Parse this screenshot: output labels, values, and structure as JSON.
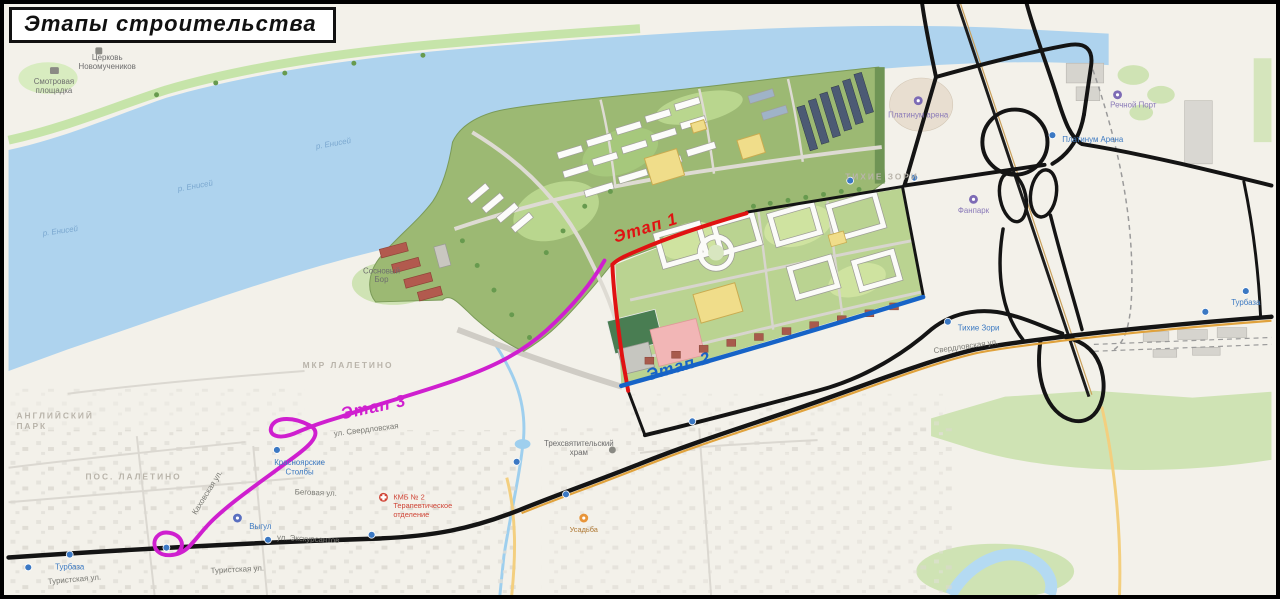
{
  "title": "Этапы строительства",
  "stages": [
    {
      "label": "Этап 1",
      "color": "#e01212"
    },
    {
      "label": "Этап 2",
      "color": "#1663c7"
    },
    {
      "label": "Этап 3",
      "color": "#cf1fcf"
    }
  ],
  "labels": {
    "river": "р. Енисей",
    "church_line1": "Церковь",
    "church_line2": "Новомучеников",
    "viewpoint_line1": "Смотровая",
    "viewpoint_line2": "площадка",
    "district_tikhie_zori": "ТИХИЕ ЗОРИ",
    "district_mkr_laletino": "МКР ЛАЛЕТИНО",
    "district_pos_laletino": "ПОС. ЛАЛЕТИНО",
    "district_english_park_line1": "АНГЛИЙСКИЙ",
    "district_english_park_line2": "ПАРК",
    "arena_poi": "Платинум арена",
    "arena_stop": "Платинум Арена",
    "rechnoy_port": "Речной Порт",
    "fanpark": "Фанпарк",
    "tikhie_zori_stop": "Тихие Зори",
    "stolby_line1": "Красноярские",
    "stolby_line2": "Столбы",
    "vygul": "Выгул",
    "turbaza": "Турбаза",
    "hospital_line1": "КМБ № 2",
    "hospital_line2": "Терапевтическое",
    "hospital_line3": "отделение",
    "temple_line1": "Трехсвятительский",
    "temple_line2": "храм",
    "usadba": "Усадьба",
    "sosnovy_line1": "Сосновый",
    "sosnovy_line2": "Бор",
    "street_sverdlovskaya_right": "Свердловская ул.",
    "street_sverdlovskaya_left": "ул. Свердловская",
    "street_ekskursantov": "ул. Экскурсантов",
    "street_turistskaya": "Туристская ул.",
    "street_begovaya": "Беговая ул.",
    "street_kakhovskaya": "Каховская ул."
  },
  "colors": {
    "frame": "#000000",
    "land": "#f3f1ea",
    "water": "#aed3ee",
    "shore_green": "#c6e4a9",
    "plan_green_1": "#9cb973",
    "plan_green_2": "#bad391",
    "road_black": "#141414",
    "highway_orange": "#e0a23c",
    "minor_yellow": "#f3cf7f",
    "building_white": "#fcfcfa",
    "building_dark": "#4c5a74",
    "building_yellow": "#f0dd8a",
    "building_red": "#b25a4e",
    "field_green": "#497d52",
    "playground_pink": "#f2b6b6"
  }
}
